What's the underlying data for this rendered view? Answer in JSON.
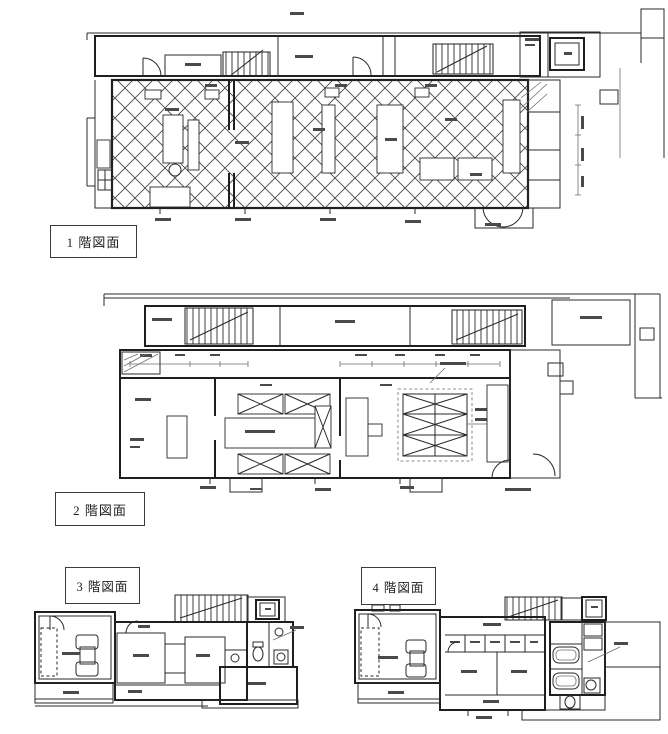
{
  "page": {
    "background": "#ffffff",
    "ink_color": "#222222"
  },
  "captions": {
    "floor1": "1 階図面",
    "floor2": "2 階図面",
    "floor3": "3 階図面",
    "floor4": "4 階図面"
  }
}
